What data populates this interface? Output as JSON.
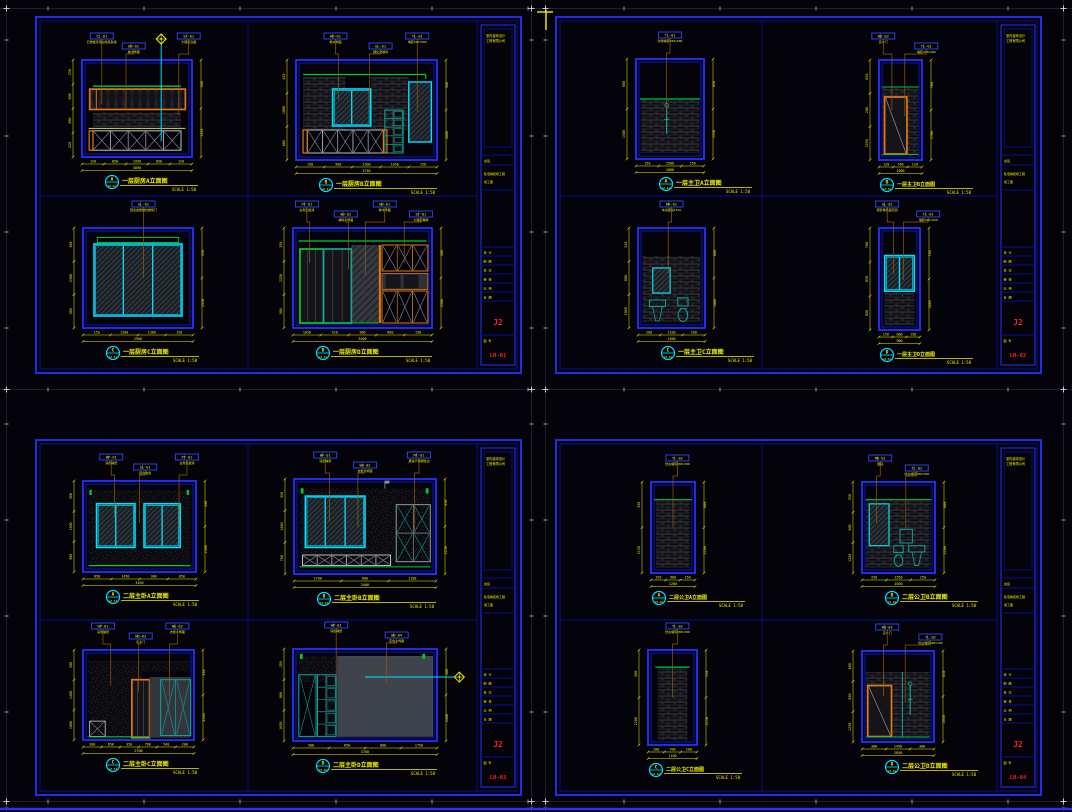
{
  "canvas": {
    "w": 1072,
    "h": 812,
    "bg": "#030309"
  },
  "colors": {
    "frame": "#0913bd",
    "frame2": "#2431ff",
    "yellow": "#f0f000",
    "orange": "#e07818",
    "cyan": "#00e0ff",
    "green": "#00cd32",
    "teal": "#12a396",
    "leader": "#8d5f13",
    "red": "#ff1f1f",
    "gray_panel": "#3f434b",
    "lightx": "#b9bcc6",
    "white": "#e5e5ea"
  },
  "scale_label": "SCALE 1:50",
  "titleblock": {
    "company": "室内装饰设计",
    "company2": "工程有限公司",
    "sign_label": "会签",
    "project": "私宅精装修工程",
    "stage": "施工图",
    "rows": [
      "设 计",
      "制 图",
      "校 对",
      "审 核",
      "比 例",
      "日 期"
    ],
    "sheet_label": "图 号"
  },
  "sheets": [
    {
      "code": "LH-01",
      "job": "J2",
      "panels": [
        {
          "letter": "A",
          "title": "一层厨房A立面图",
          "callouts": [
            {
              "code": "CL-01",
              "desc": "石膏板吊顶白色乳胶漆"
            },
            {
              "code": "WD-01",
              "desc": "橡木饰面"
            },
            {
              "code": "ST-01",
              "desc": "大理石台面"
            }
          ],
          "dims_left": [
            "250",
            "600",
            "980",
            "420"
          ],
          "dims_right": [
            "300",
            "1950"
          ],
          "dims_bottom": [
            "120",
            "850",
            "1950",
            "850",
            "120"
          ]
        },
        {
          "letter": "B",
          "title": "一层厨房B立面图",
          "callouts": [
            {
              "code": "WD-01",
              "desc": "橡木饰面"
            },
            {
              "code": "GL-01",
              "desc": "钢化清玻璃"
            },
            {
              "code": "TL-01",
              "desc": "墙砖300×600"
            }
          ],
          "dims_left": [
            "420",
            "1800",
            "680"
          ],
          "dims_right": [
            "300",
            "2600"
          ],
          "dims_bottom": [
            "150",
            "900",
            "1500",
            "1050",
            "150"
          ]
        },
        {
          "letter": "C",
          "title": "一层厨房C立面图",
          "callouts": [
            {
              "code": "GL-01",
              "desc": "铝合金框推拉玻璃门"
            }
          ],
          "dims_left": [
            "300",
            "2300",
            "300"
          ],
          "dims_right": [
            "350",
            "2550"
          ],
          "dims_bottom": [
            "150",
            "1300",
            "1300",
            "150"
          ]
        },
        {
          "letter": "D",
          "title": "一层厨房D立面图",
          "callouts": [
            {
              "code": "PT-01",
              "desc": "白色乳胶漆"
            },
            {
              "code": "WD-02",
              "desc": "胡桃木饰面"
            },
            {
              "code": "WD-01",
              "desc": "橡木饰面"
            },
            {
              "code": "ST-01",
              "desc": "大理石踢脚"
            }
          ],
          "dims_left": [
            "350",
            "2250",
            "300"
          ],
          "dims_right": [
            "400",
            "2500"
          ],
          "dims_bottom": [
            "1050",
            "420",
            "900",
            "880",
            "150"
          ]
        }
      ]
    },
    {
      "code": "LH-02",
      "job": "J2",
      "panels": [
        {
          "letter": "A",
          "title": "一层主卫A立面图",
          "callouts": [
            {
              "code": "TL-01",
              "desc": "防滑墙砖300×600"
            }
          ],
          "dims_left": [
            "900",
            "1500"
          ],
          "dims_right": [
            "850",
            "1550"
          ],
          "dims_bottom": [
            "150",
            "1500",
            "150"
          ]
        },
        {
          "letter": "B",
          "title": "一层主卫B立面图",
          "callouts": [
            {
              "code": "WD-03",
              "desc": "实木门"
            },
            {
              "code": "TL-01",
              "desc": "墙砖300×600"
            }
          ],
          "dims_left": [
            "650",
            "260",
            "1490"
          ],
          "dims_right": [
            "700",
            "1700"
          ],
          "dims_bottom": [
            "120",
            "760",
            "120"
          ]
        },
        {
          "letter": "C",
          "title": "一层主卫C立面图",
          "callouts": [
            {
              "code": "MR-01",
              "desc": "车边银镜15mm"
            }
          ],
          "dims_left": [
            "520",
            "880",
            "1000"
          ],
          "dims_right": [
            "600",
            "1800"
          ],
          "dims_bottom": [
            "200",
            "1100",
            "200"
          ]
        },
        {
          "letter": "D",
          "title": "一层主卫D立面图",
          "callouts": [
            {
              "code": "GL-02",
              "desc": "磨砂玻璃固定窗"
            },
            {
              "code": "TL-01",
              "desc": "墙砖300×600"
            }
          ],
          "dims_left": [
            "700",
            "850",
            "850"
          ],
          "dims_right": [
            "750",
            "1650"
          ],
          "dims_bottom": [
            "150",
            "600",
            "150"
          ]
        }
      ]
    },
    {
      "code": "LH-03",
      "job": "J2",
      "panels": [
        {
          "letter": "A",
          "title": "二层主卧A立面图",
          "callouts": [
            {
              "code": "WP-01",
              "desc": "深色墙纸"
            },
            {
              "code": "GL-01",
              "desc": "铝合金窗"
            },
            {
              "code": "PT-01",
              "desc": "白色乳胶漆"
            }
          ],
          "dims_left": [
            "300",
            "1500",
            "900"
          ],
          "dims_right": [
            "400",
            "2300"
          ],
          "dims_bottom": [
            "850",
            "1450",
            "300",
            "850"
          ]
        },
        {
          "letter": "B",
          "title": "二层主卧B立面图",
          "callouts": [
            {
              "code": "WP-01",
              "desc": "深色墙纸"
            },
            {
              "code": "WD-02",
              "desc": "衣柜木饰面"
            },
            {
              "code": "MT-01",
              "desc": "黑钛不锈钢收边"
            }
          ],
          "dims_left": [
            "350",
            "1650",
            "700"
          ],
          "dims_right": [
            "450",
            "2250"
          ],
          "dims_bottom": [
            "1700",
            "600",
            "1100"
          ]
        },
        {
          "letter": "C",
          "title": "二层主卧C立面图",
          "callouts": [
            {
              "code": "WP-01",
              "desc": "深色墙纸"
            },
            {
              "code": "WD-03",
              "desc": "实木门"
            },
            {
              "code": "WD-02",
              "desc": "衣柜木饰面"
            }
          ],
          "dims_left": [
            "300",
            "1400",
            "1000"
          ],
          "dims_right": [
            "350",
            "2350"
          ],
          "dims_bottom": [
            "200",
            "650",
            "350",
            "760",
            "540",
            "200"
          ]
        },
        {
          "letter": "D",
          "title": "二层主卧D立面图",
          "callouts": [
            {
              "code": "WP-01",
              "desc": "深色墙纸"
            },
            {
              "code": "WD-04",
              "desc": "灰色木饰面"
            }
          ],
          "dims_left": [
            "250",
            "800",
            "1650"
          ],
          "dims_right": [
            "300",
            "2400"
          ],
          "dims_bottom": [
            "500",
            "650",
            "800",
            "1750"
          ]
        }
      ]
    },
    {
      "code": "LH-04",
      "job": "J2",
      "panels": [
        {
          "letter": "A",
          "title": "二层公卫A立面图",
          "callouts": [
            {
              "code": "TL-02",
              "desc": "仿古墙砖300×300"
            }
          ],
          "dims_left": [
            "550",
            "2150"
          ],
          "dims_right": [
            "600",
            "2100"
          ],
          "dims_bottom": [
            "150",
            "900",
            "150"
          ]
        },
        {
          "letter": "B",
          "title": "二层公卫B立面图",
          "callouts": [
            {
              "code": "MR-01",
              "desc": "银镜"
            },
            {
              "code": "TL-02",
              "desc": "仿古墙砖300×300"
            }
          ],
          "dims_left": [
            "550",
            "900",
            "1250"
          ],
          "dims_right": [
            "600",
            "2100"
          ],
          "dims_bottom": [
            "250",
            "1550",
            "250"
          ]
        },
        {
          "letter": "C",
          "title": "二层公卫C立面图",
          "callouts": [
            {
              "code": "TL-02",
              "desc": "仿古墙砖300×300"
            }
          ],
          "dims_left": [
            "500",
            "2200"
          ],
          "dims_right": [
            "550",
            "2150"
          ],
          "dims_bottom": [
            "200",
            "700",
            "200"
          ]
        },
        {
          "letter": "D",
          "title": "二层公卫D立面图",
          "callouts": [
            {
              "code": "WD-03",
              "desc": "实木门"
            },
            {
              "code": "TL-02",
              "desc": "仿古墙砖300×300"
            }
          ],
          "dims_left": [
            "600",
            "850",
            "1250"
          ],
          "dims_right": [
            "650",
            "2050"
          ],
          "dims_bottom": [
            "300",
            "1450",
            "300"
          ]
        }
      ]
    }
  ]
}
